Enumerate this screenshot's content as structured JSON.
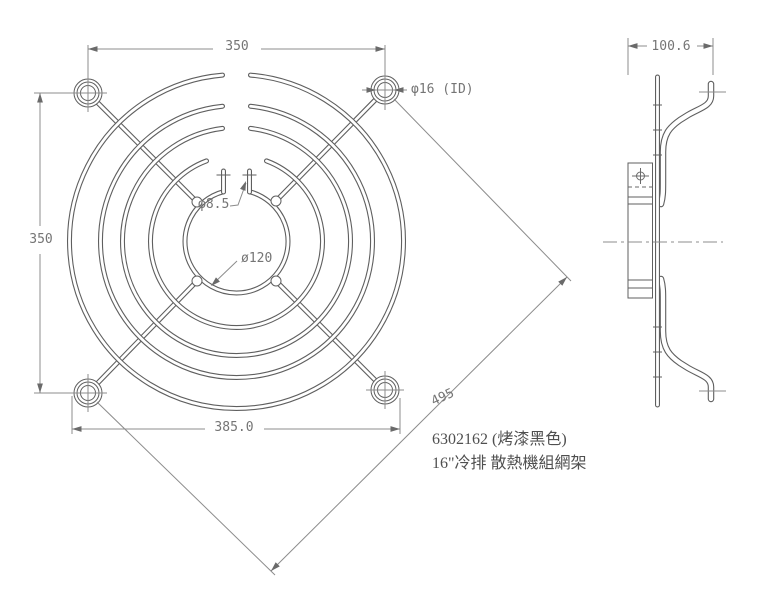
{
  "front_view": {
    "dim_hole_pitch_width": "350",
    "dim_hole_pitch_height": "350",
    "dim_outer_width": "385.0",
    "dim_diagonal": "495",
    "label_mount_hole": "φ16 (ID)",
    "label_wire_end_hole": "φ8.5",
    "label_center_ring": "ø120"
  },
  "side_view": {
    "dim_depth": "100.6"
  },
  "notes": {
    "part_number": "6302162 (烤漆黑色)",
    "description": "16\"冷排 散熱機組網架"
  },
  "colors": {
    "background": "#ffffff",
    "line": "#5f5f5f",
    "dim": "#8c8c8c",
    "accent": "#6a6a6a",
    "dim_text": "#757575",
    "note_text": "#4f4f4f"
  }
}
